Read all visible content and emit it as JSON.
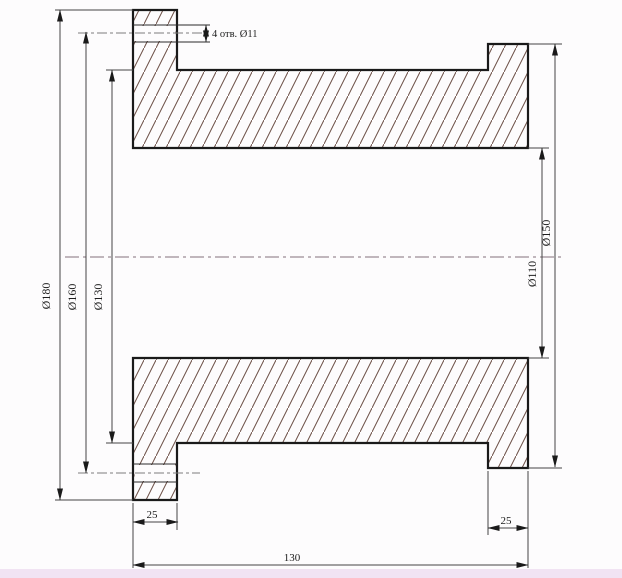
{
  "drawing": {
    "labels": {
      "dia_flange_left": "Ø180",
      "dia_bolt_circle": "Ø160",
      "dia_body": "Ø130",
      "dia_flange_right": "Ø150",
      "dia_bore": "Ø110",
      "holes_note": "4 отв. Ø11",
      "flange_left_thickness": "25",
      "flange_right_thickness": "25",
      "overall_length": "130"
    },
    "colors": {
      "outline": "#1a1a1a",
      "dimension_line": "#454545",
      "hatch": "#6b4e46",
      "centerline_main": "#9b8b95",
      "centerline_hole": "#7d7d7d",
      "background": "#fdfcfd",
      "bottom_strip": "#f1e3f3"
    }
  }
}
